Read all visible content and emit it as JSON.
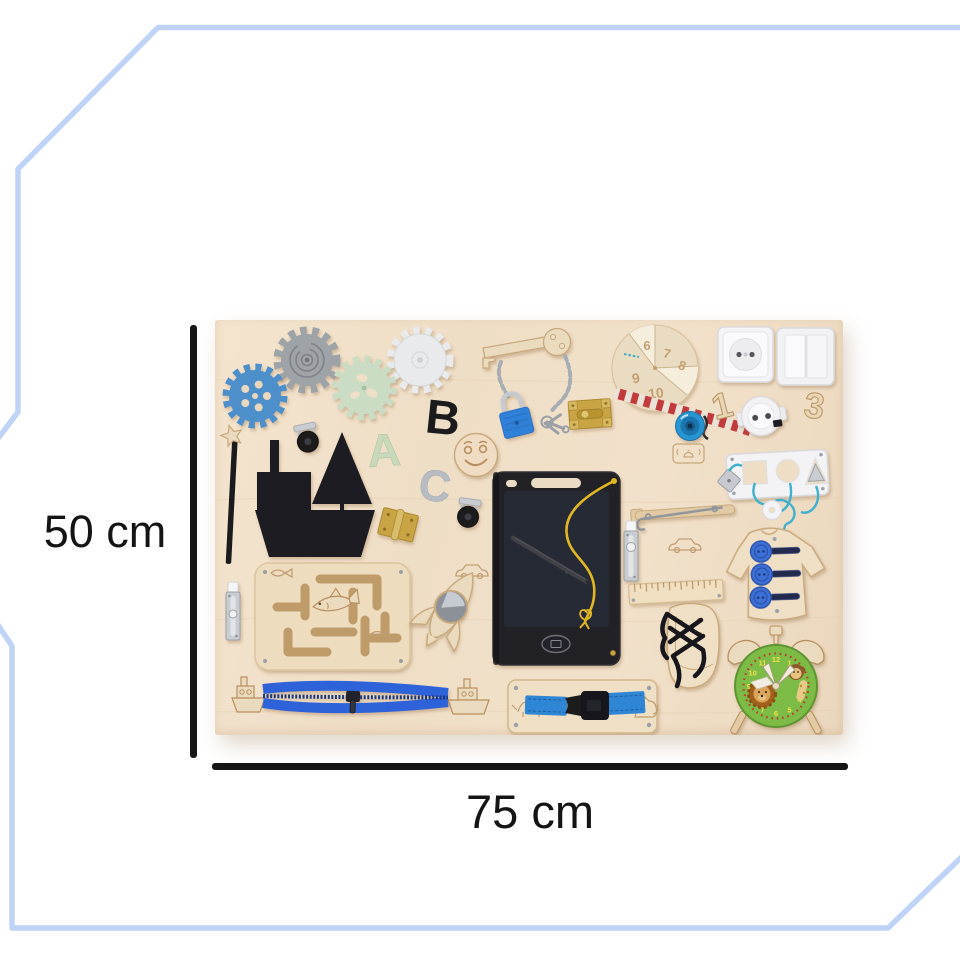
{
  "annotations": {
    "height_label": "50 cm",
    "width_label": "75 cm"
  },
  "frame": {
    "color": "#bfd3f6"
  },
  "board": {
    "letters": [
      "A",
      "B",
      "C"
    ],
    "numbers": [
      "1",
      "3"
    ],
    "clock_disc_numbers": [
      "6",
      "7",
      "8",
      "9",
      "10"
    ],
    "alarm_clock_numbers": [
      "12",
      "1",
      "2",
      "3",
      "4",
      "5",
      "6",
      "7",
      "8",
      "9",
      "10",
      "11"
    ],
    "colors": {
      "wood": "#efdec6",
      "engraving": "#c19e72",
      "accent_blue": "#2e62d9",
      "padlock_blue": "#2f80d8",
      "bell_blue": "#2795d2",
      "clock_green": "#7cbb45",
      "brass": "#c9a445",
      "black_toy": "#1d1d20"
    },
    "items": [
      {
        "name": "gear-blue",
        "color": "#4e8fcb"
      },
      {
        "name": "gear-gray-spiral",
        "color": "#9ea3a8"
      },
      {
        "name": "gear-green",
        "color": "#cbdcc4"
      },
      {
        "name": "gear-white",
        "color": "#e9eaec"
      },
      {
        "name": "caster-wheel",
        "color": "#1a1a1e"
      },
      {
        "name": "ship-chalkboard",
        "color": "#1d1d20"
      },
      {
        "name": "star-wand",
        "color": "#eadbbe"
      },
      {
        "name": "smiley-face-disc",
        "color": "#efdcc3"
      },
      {
        "name": "wooden-key-with-chain",
        "color": "#eadbbe"
      },
      {
        "name": "padlock-with-keys",
        "color": "#2f80d8"
      },
      {
        "name": "brass-slide-latch",
        "color": "#c9a445"
      },
      {
        "name": "brass-hinge",
        "color": "#c9a445"
      },
      {
        "name": "clock-disc",
        "color": "#eadcc2"
      },
      {
        "name": "power-socket",
        "color": "#f4f4f6"
      },
      {
        "name": "double-light-switch",
        "color": "#f2f2f4"
      },
      {
        "name": "power-plug",
        "color": "#f2f2f4"
      },
      {
        "name": "striped-rope",
        "color": "#c23b3b"
      },
      {
        "name": "bicycle-bell",
        "color": "#2795d2"
      },
      {
        "name": "shape-sorter-plate",
        "color": "#f3f3f5"
      },
      {
        "name": "hook-latch-bar",
        "color": "#e2cba4"
      },
      {
        "name": "silver-slide-bolt",
        "color": "#c9cdd2"
      },
      {
        "name": "lcd-writing-tablet-with-stylus",
        "color": "#202025"
      },
      {
        "name": "shirt-with-buttons",
        "color": "#efdfc5"
      },
      {
        "name": "ruler",
        "color": "#f0dfc0"
      },
      {
        "name": "lacing-shoe",
        "color": "#efdfc5"
      },
      {
        "name": "alarm-clock-lion",
        "color": "#7cbb45"
      },
      {
        "name": "shark-maze",
        "color": "#eddcbe"
      },
      {
        "name": "rocket-with-mirror",
        "color": "#eadbbe"
      },
      {
        "name": "zipper-with-boats",
        "color": "#2e62d9"
      },
      {
        "name": "buckle-plate",
        "color": "#efdfc5"
      }
    ]
  }
}
